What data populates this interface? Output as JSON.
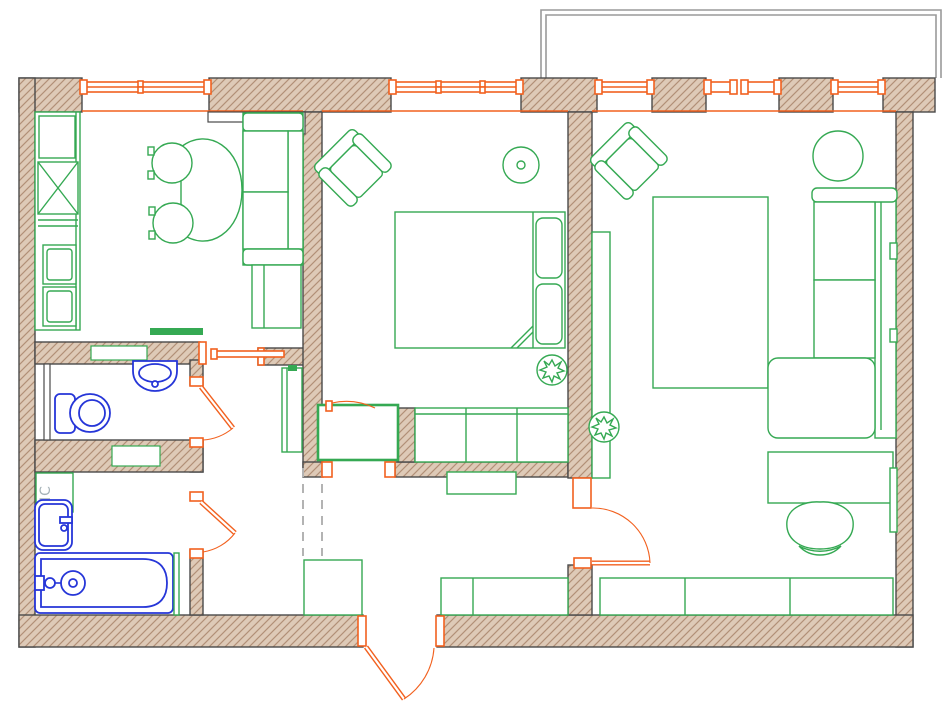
{
  "labels": {
    "washing_machine": "МС"
  },
  "colors": {
    "background": "#ffffff",
    "wall_fill": "#decab7",
    "wall_hatch": "#b29077",
    "wall_outline": "#4a4a4a",
    "furniture": "#35a953",
    "sanitary": "#2636d8",
    "openings": "#f2611f",
    "balcony": "#9a9a9a",
    "dashed": "#b3b3b3",
    "label_text": "#a5b2b8"
  },
  "inventory": {
    "rooms": [
      "kitchen",
      "bedroom",
      "living-room",
      "wc",
      "bathroom",
      "hallway"
    ],
    "kitchen": [
      "window",
      "counter-with-sink",
      "drawers",
      "dining-table",
      "two-chairs",
      "sofa",
      "shelf-unit",
      "duct"
    ],
    "bedroom": [
      "window",
      "armchair",
      "round-side-table",
      "double-bed",
      "pillows",
      "plant",
      "wardrobe",
      "cabinet",
      "door"
    ],
    "living_room": [
      "windows",
      "armchair",
      "round-table",
      "corner-sofa",
      "bed",
      "media-unit",
      "desk",
      "desk-chair",
      "radiator",
      "low-cabinets",
      "plant",
      "door"
    ],
    "wc": [
      "toilet",
      "wall-sink",
      "door"
    ],
    "bathroom": [
      "washing-machine",
      "sink",
      "bathtub",
      "door"
    ],
    "hallway": [
      "tall-cabinet",
      "dashed-closet",
      "console",
      "low-cabinets",
      "shoe-cabinet",
      "entrance-door"
    ],
    "exterior": [
      "balcony-outline",
      "windows"
    ]
  }
}
